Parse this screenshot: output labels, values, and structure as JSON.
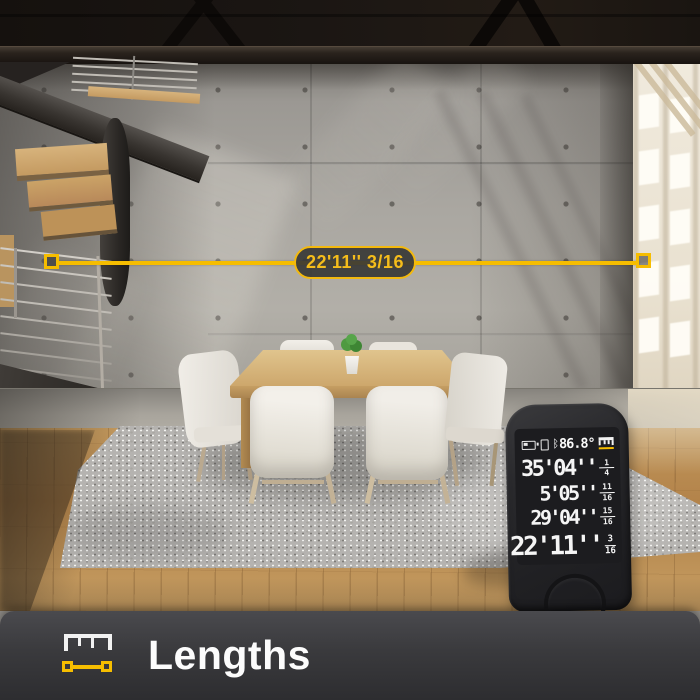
{
  "measurement": {
    "label": "22'11'' 3/16"
  },
  "device_screen": {
    "status": {
      "angle": "86.8°"
    },
    "history": [
      {
        "feet": "35'04''",
        "num": "1",
        "den": "4"
      },
      {
        "feet": "5'05''",
        "num": "11",
        "den": "16"
      },
      {
        "feet": "29'04''",
        "num": "15",
        "den": "16"
      }
    ],
    "current": {
      "feet": "22'11''",
      "num": "3",
      "den": "16"
    }
  },
  "footer": {
    "label": "Lengths"
  },
  "colors": {
    "accent_yellow": "#F6BE00",
    "footer_bg": "#3A3A3D",
    "device_body": "#232325"
  }
}
